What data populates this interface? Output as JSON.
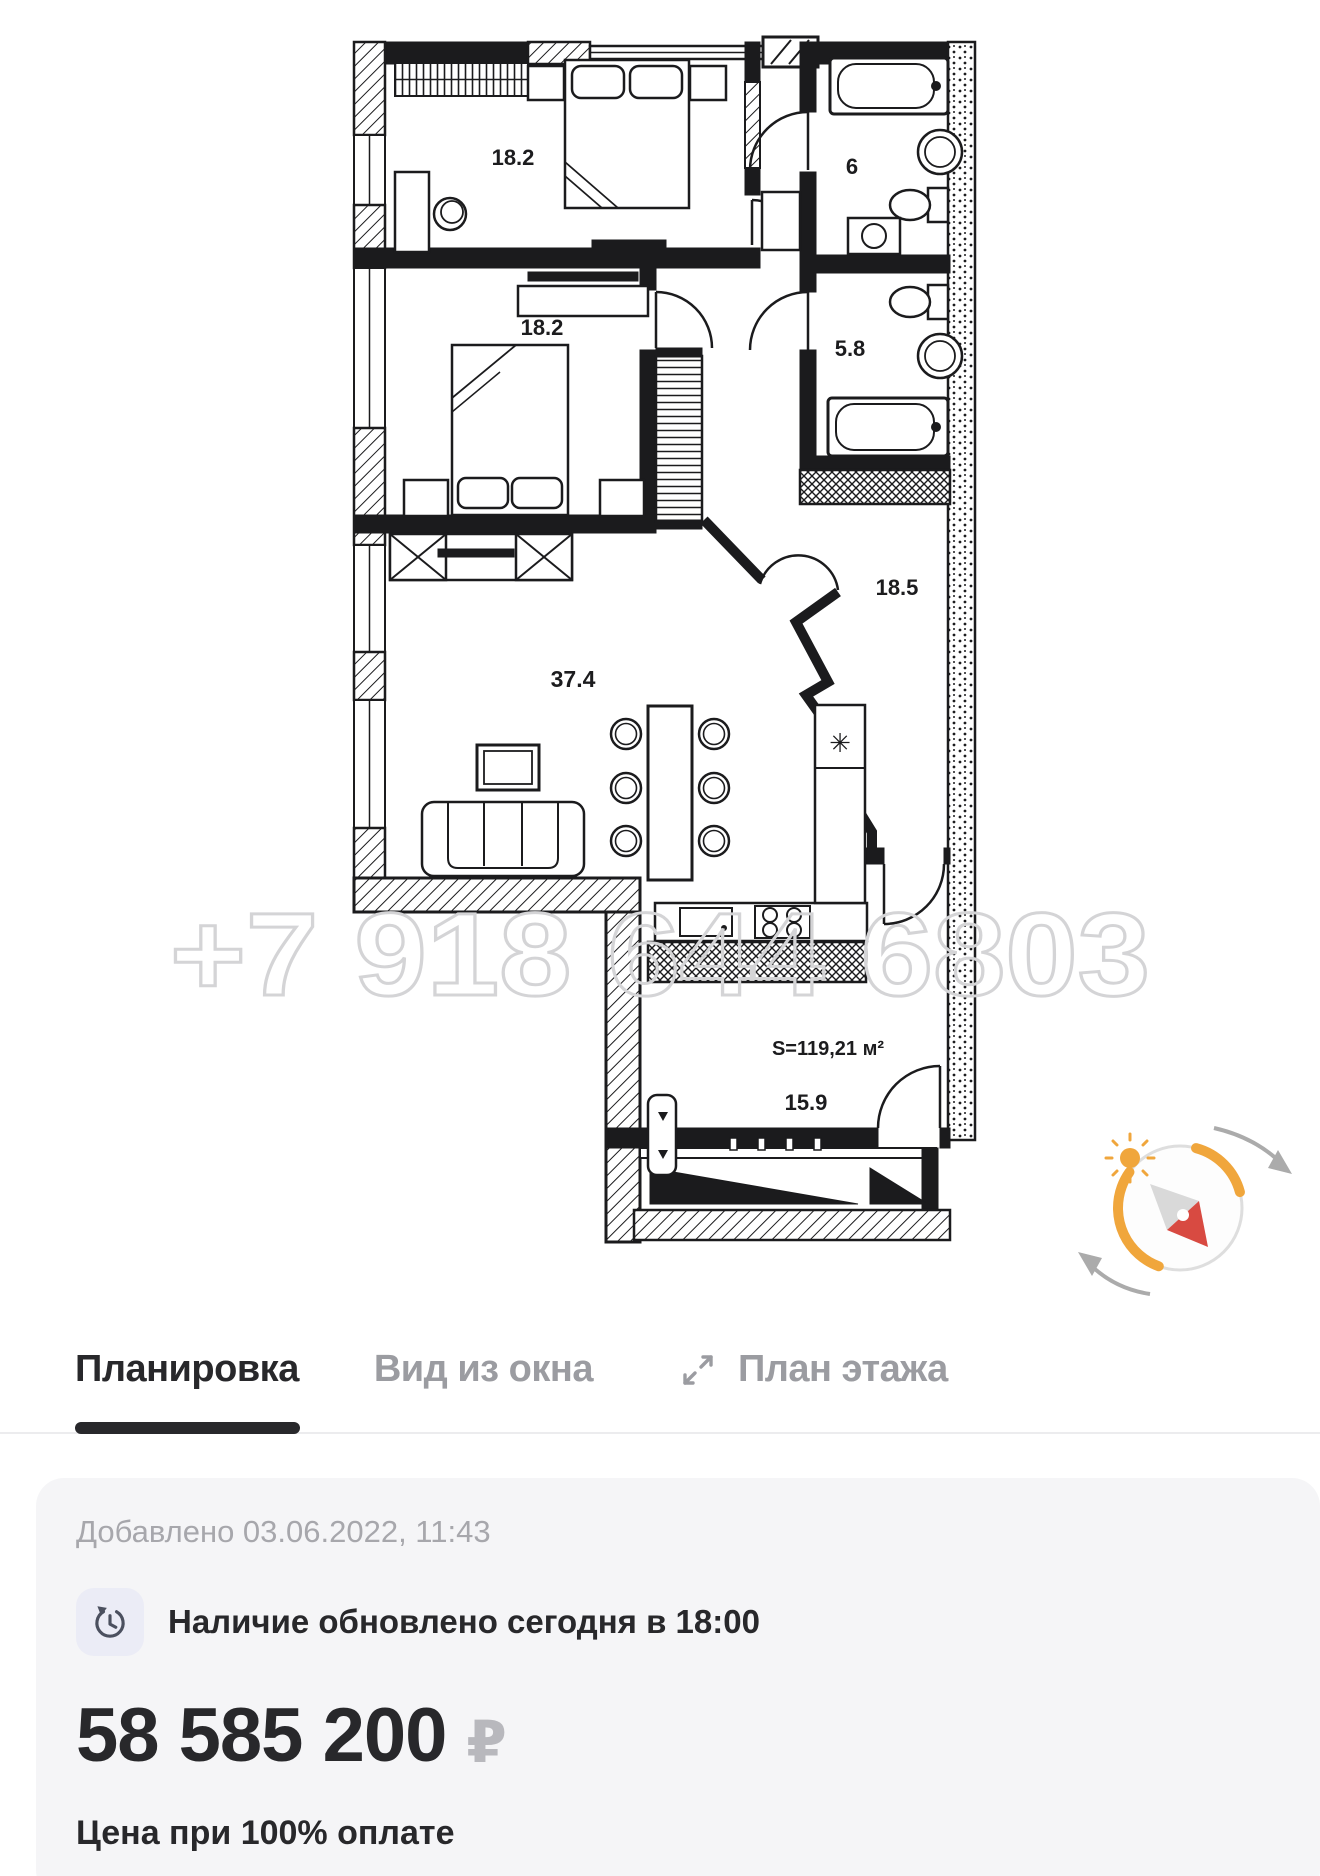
{
  "watermark": "+7 918 644 6803",
  "plan": {
    "rooms": [
      {
        "id": "bedroom-1",
        "area": "18.2"
      },
      {
        "id": "bedroom-2",
        "area": "18.2"
      },
      {
        "id": "bathroom-1",
        "area": "6"
      },
      {
        "id": "bathroom-2",
        "area": "5.8"
      },
      {
        "id": "hallway",
        "area": "18.5"
      },
      {
        "id": "living-kitchen",
        "area": "37.4"
      },
      {
        "id": "kitchen-room",
        "area": "15.9"
      }
    ],
    "total_area_label": "S=119,21 м²",
    "fridge_mark": "✳"
  },
  "tabs": {
    "layout": "Планировка",
    "window_view": "Вид из окна",
    "floor_plan": "План этажа"
  },
  "card": {
    "added": "Добавлено 03.06.2022, 11:43",
    "availability": "Наличие обновлено сегодня в 18:00",
    "price": "58 585 200",
    "currency": "₽",
    "price_note": "Цена при 100% оплате"
  },
  "icons": {
    "expand": "expand-arrows",
    "availability": "clock-refresh",
    "compass": "compass-with-sun"
  },
  "colors": {
    "accent_orange": "#F0A63C",
    "needle_red": "#D84A41",
    "active_tab": "#28282B",
    "inactive_tab": "#9B9CA1",
    "card_bg": "#F5F5F7",
    "watermark_gray": "#D4D4D6",
    "wall_black": "#1B1B1D"
  }
}
